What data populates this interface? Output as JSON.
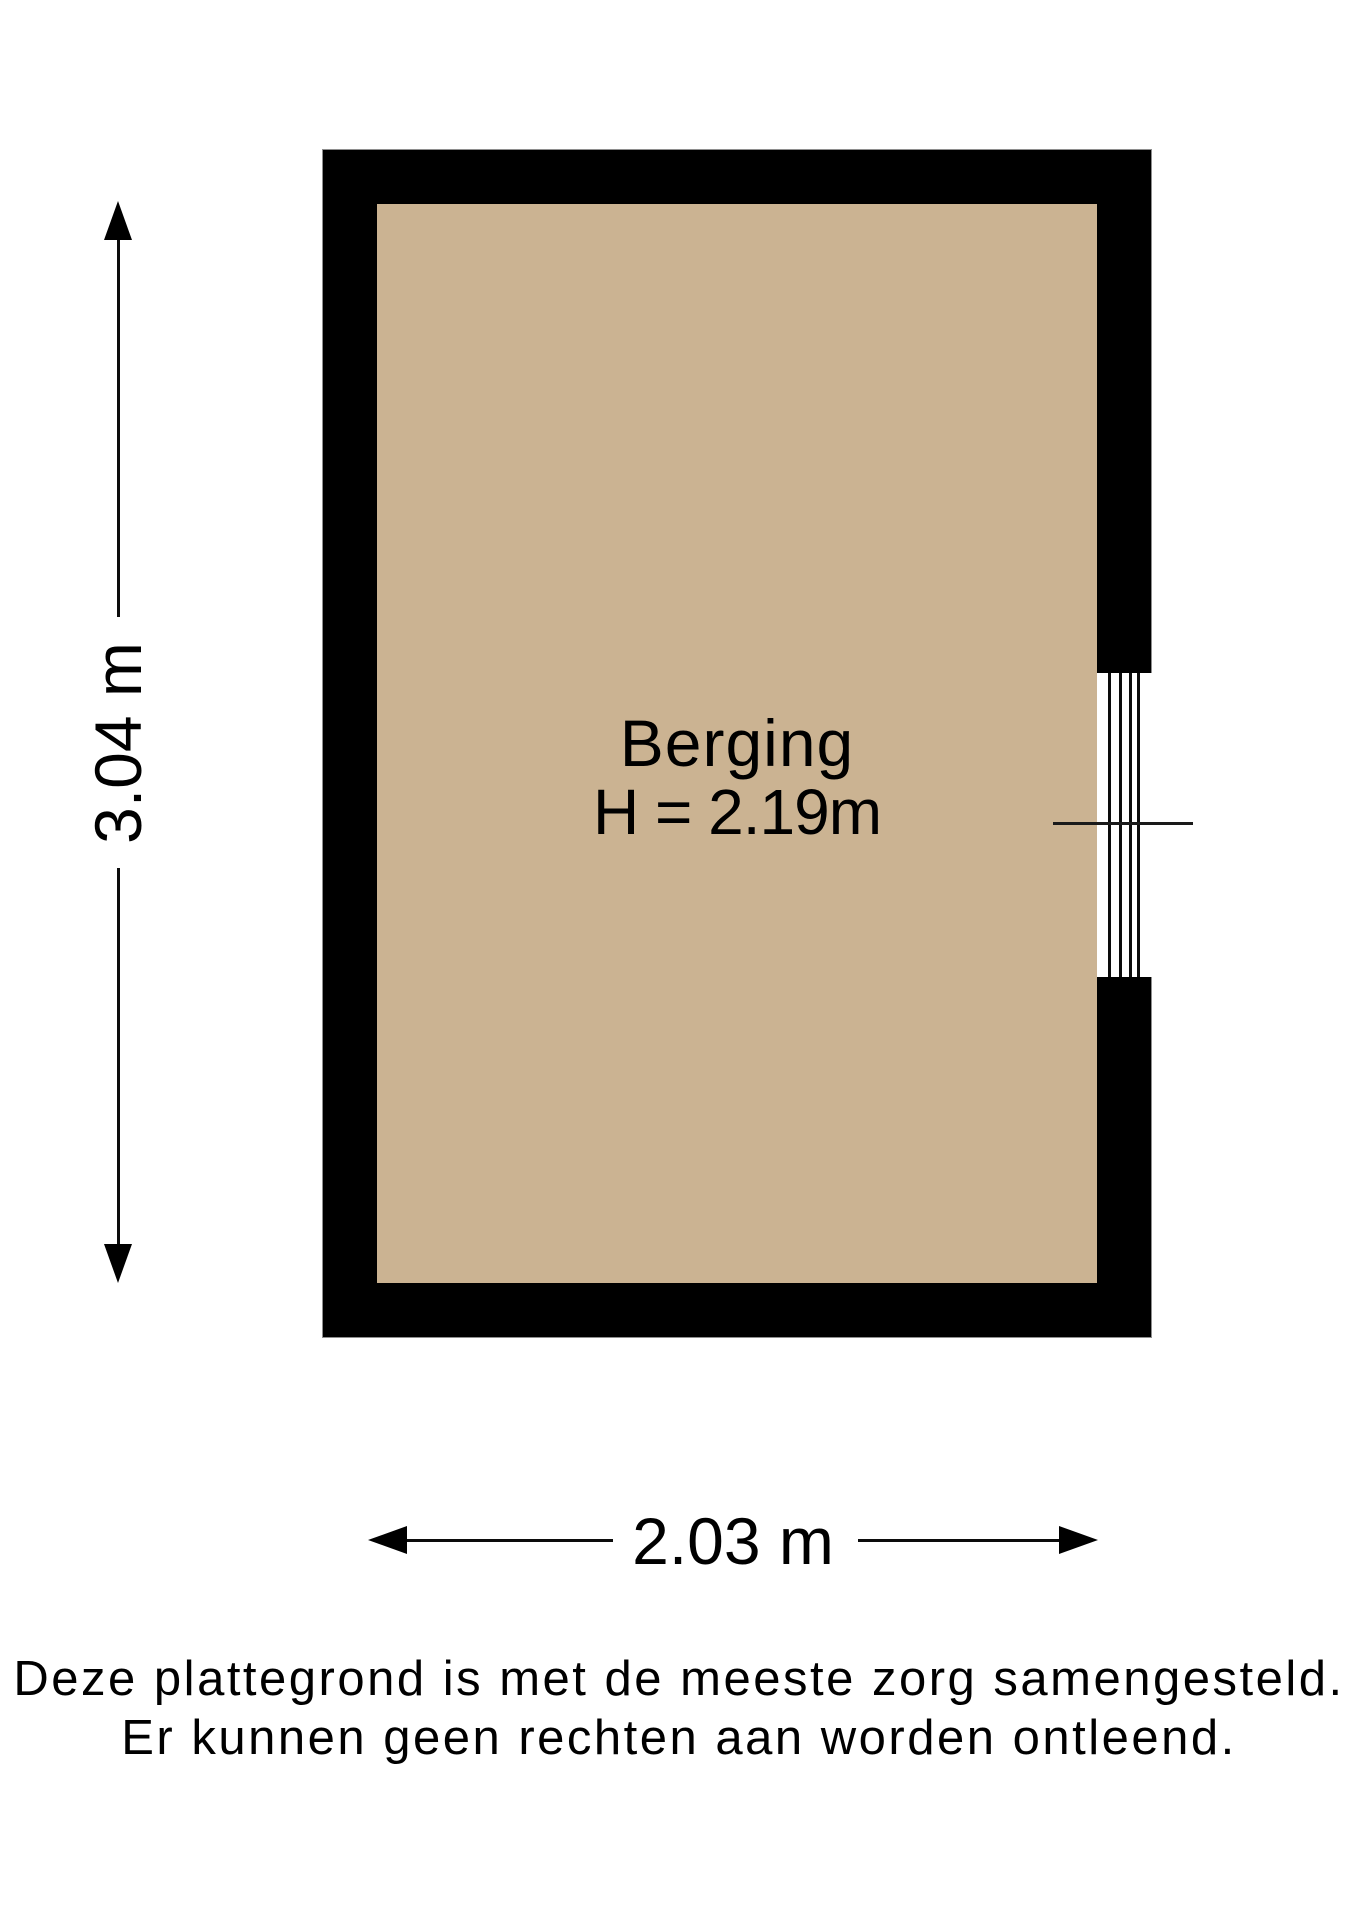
{
  "floorplan": {
    "room": {
      "name": "Berging",
      "height_label": "H = 2.19m",
      "floor_color": "#cbb392",
      "wall_color": "#000000"
    },
    "dimensions": {
      "vertical_label": "3.04 m",
      "horizontal_label": "2.03 m"
    },
    "window": {
      "glazing_lines": 4
    },
    "disclaimer": {
      "line1": "Deze plattegrond is met de meeste zorg samengesteld.",
      "line2": "Er kunnen geen rechten aan worden ontleend."
    }
  }
}
